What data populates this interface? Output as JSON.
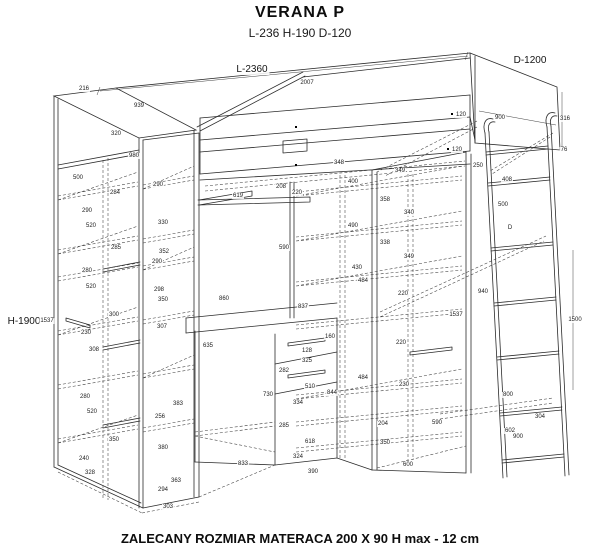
{
  "header": {
    "title": "VERANA P",
    "subtitle": "L-236 H-190 D-120"
  },
  "footer": {
    "note": "ZALECANY ROZMIAR MATERACA 200 X 90  H max - 12 cm"
  },
  "primary_dimensions": [
    {
      "text": "L-2360",
      "x": 252,
      "y": 70
    },
    {
      "text": "D-1200",
      "x": 530,
      "y": 61
    },
    {
      "text": "H-1900",
      "x": 24,
      "y": 322
    }
  ],
  "dimension_labels": [
    {
      "text": "216",
      "x": 84,
      "y": 89
    },
    {
      "text": "939",
      "x": 139,
      "y": 106
    },
    {
      "text": "320",
      "x": 116,
      "y": 134
    },
    {
      "text": "980",
      "x": 134,
      "y": 156
    },
    {
      "text": "500",
      "x": 78,
      "y": 178
    },
    {
      "text": "284",
      "x": 115,
      "y": 193
    },
    {
      "text": "290",
      "x": 158,
      "y": 185
    },
    {
      "text": "290",
      "x": 87,
      "y": 211
    },
    {
      "text": "520",
      "x": 91,
      "y": 226
    },
    {
      "text": "330",
      "x": 163,
      "y": 223
    },
    {
      "text": "285",
      "x": 116,
      "y": 248
    },
    {
      "text": "352",
      "x": 164,
      "y": 252
    },
    {
      "text": "290",
      "x": 157,
      "y": 262
    },
    {
      "text": "280",
      "x": 87,
      "y": 271
    },
    {
      "text": "520",
      "x": 91,
      "y": 287
    },
    {
      "text": "298",
      "x": 159,
      "y": 290
    },
    {
      "text": "350",
      "x": 163,
      "y": 300
    },
    {
      "text": "300",
      "x": 114,
      "y": 315
    },
    {
      "text": "1537",
      "x": 47,
      "y": 321
    },
    {
      "text": "307",
      "x": 162,
      "y": 327
    },
    {
      "text": "230",
      "x": 86,
      "y": 333
    },
    {
      "text": "308",
      "x": 94,
      "y": 350
    },
    {
      "text": "280",
      "x": 85,
      "y": 397
    },
    {
      "text": "383",
      "x": 178,
      "y": 404
    },
    {
      "text": "520",
      "x": 92,
      "y": 412
    },
    {
      "text": "256",
      "x": 160,
      "y": 417
    },
    {
      "text": "350",
      "x": 114,
      "y": 440
    },
    {
      "text": "380",
      "x": 163,
      "y": 448
    },
    {
      "text": "240",
      "x": 84,
      "y": 459
    },
    {
      "text": "328",
      "x": 90,
      "y": 473
    },
    {
      "text": "363",
      "x": 176,
      "y": 481
    },
    {
      "text": "294",
      "x": 163,
      "y": 490
    },
    {
      "text": "303",
      "x": 168,
      "y": 507
    },
    {
      "text": "2007",
      "x": 307,
      "y": 83
    },
    {
      "text": "208",
      "x": 281,
      "y": 187
    },
    {
      "text": "220",
      "x": 297,
      "y": 193
    },
    {
      "text": "619",
      "x": 238,
      "y": 196
    },
    {
      "text": "120",
      "x": 461,
      "y": 115
    },
    {
      "text": "900",
      "x": 500,
      "y": 118
    },
    {
      "text": "316",
      "x": 565,
      "y": 119
    },
    {
      "text": "120",
      "x": 457,
      "y": 150
    },
    {
      "text": "76",
      "x": 564,
      "y": 150
    },
    {
      "text": "348",
      "x": 339,
      "y": 163
    },
    {
      "text": "250",
      "x": 478,
      "y": 166
    },
    {
      "text": "349",
      "x": 400,
      "y": 171
    },
    {
      "text": "408",
      "x": 507,
      "y": 180
    },
    {
      "text": "400",
      "x": 353,
      "y": 182
    },
    {
      "text": "358",
      "x": 385,
      "y": 200
    },
    {
      "text": "500",
      "x": 503,
      "y": 205
    },
    {
      "text": "340",
      "x": 409,
      "y": 213
    },
    {
      "text": "490",
      "x": 353,
      "y": 226
    },
    {
      "text": "D",
      "x": 510,
      "y": 228
    },
    {
      "text": "338",
      "x": 385,
      "y": 243
    },
    {
      "text": "590",
      "x": 284,
      "y": 248
    },
    {
      "text": "349",
      "x": 409,
      "y": 257
    },
    {
      "text": "430",
      "x": 357,
      "y": 268
    },
    {
      "text": "484",
      "x": 363,
      "y": 281
    },
    {
      "text": "940",
      "x": 483,
      "y": 292
    },
    {
      "text": "220",
      "x": 403,
      "y": 294
    },
    {
      "text": "860",
      "x": 224,
      "y": 299
    },
    {
      "text": "837",
      "x": 303,
      "y": 307
    },
    {
      "text": "1537",
      "x": 456,
      "y": 315
    },
    {
      "text": "1500",
      "x": 575,
      "y": 320
    },
    {
      "text": "160",
      "x": 330,
      "y": 337
    },
    {
      "text": "220",
      "x": 401,
      "y": 343
    },
    {
      "text": "635",
      "x": 208,
      "y": 346
    },
    {
      "text": "128",
      "x": 307,
      "y": 351
    },
    {
      "text": "325",
      "x": 307,
      "y": 361
    },
    {
      "text": "282",
      "x": 284,
      "y": 371
    },
    {
      "text": "484",
      "x": 363,
      "y": 378
    },
    {
      "text": "230",
      "x": 404,
      "y": 385
    },
    {
      "text": "510",
      "x": 310,
      "y": 387
    },
    {
      "text": "844",
      "x": 332,
      "y": 393
    },
    {
      "text": "800",
      "x": 508,
      "y": 395
    },
    {
      "text": "730",
      "x": 268,
      "y": 395
    },
    {
      "text": "334",
      "x": 298,
      "y": 403
    },
    {
      "text": "304",
      "x": 540,
      "y": 417
    },
    {
      "text": "590",
      "x": 437,
      "y": 423
    },
    {
      "text": "204",
      "x": 383,
      "y": 424
    },
    {
      "text": "285",
      "x": 284,
      "y": 426
    },
    {
      "text": "602",
      "x": 510,
      "y": 431
    },
    {
      "text": "900",
      "x": 518,
      "y": 437
    },
    {
      "text": "618",
      "x": 310,
      "y": 442
    },
    {
      "text": "350",
      "x": 385,
      "y": 443
    },
    {
      "text": "324",
      "x": 298,
      "y": 457
    },
    {
      "text": "833",
      "x": 243,
      "y": 464
    },
    {
      "text": "600",
      "x": 408,
      "y": 465
    },
    {
      "text": "390",
      "x": 313,
      "y": 472
    }
  ],
  "marker_dots": [
    {
      "x": 452,
      "y": 114
    },
    {
      "x": 448,
      "y": 149
    },
    {
      "x": 296,
      "y": 127
    },
    {
      "x": 296,
      "y": 165
    }
  ]
}
